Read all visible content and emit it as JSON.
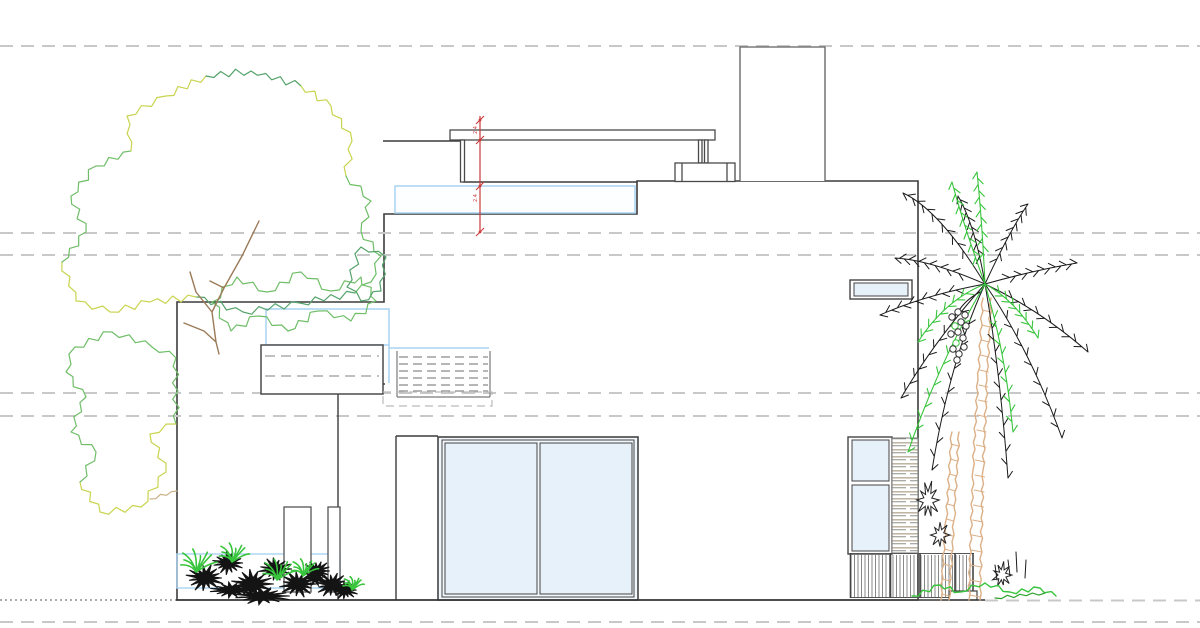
{
  "drawing": {
    "name": "residential-side-elevation",
    "dimension": {
      "labels": [
        "2.4",
        "2.4"
      ]
    },
    "guides": {
      "y_positions": [
        46,
        233,
        255,
        393,
        416,
        622
      ],
      "ground_y": 600
    },
    "colors": {
      "outline": "#3c3c3c",
      "light_outline": "#5f5f5f",
      "glass_fill": "#e7f1fa",
      "glass_fill_light": "#f2f7fc",
      "glass_stroke": "#a9d3f2",
      "guide": "#c8c8c8",
      "dim_red": "#cc3a3a",
      "tree_green": "#6fbe67",
      "tree_yellow": "#c9d44e",
      "tree_dark_green": "#55a36b",
      "branch_brown": "#9b7a58",
      "branch_tan": "#c8b084",
      "fern_green": "#38c43c",
      "palm_trunk": "#dcb087",
      "ink": "#1a1a1a",
      "shrub_black": "#141414",
      "grey_dash": "#9a9a9a"
    }
  }
}
